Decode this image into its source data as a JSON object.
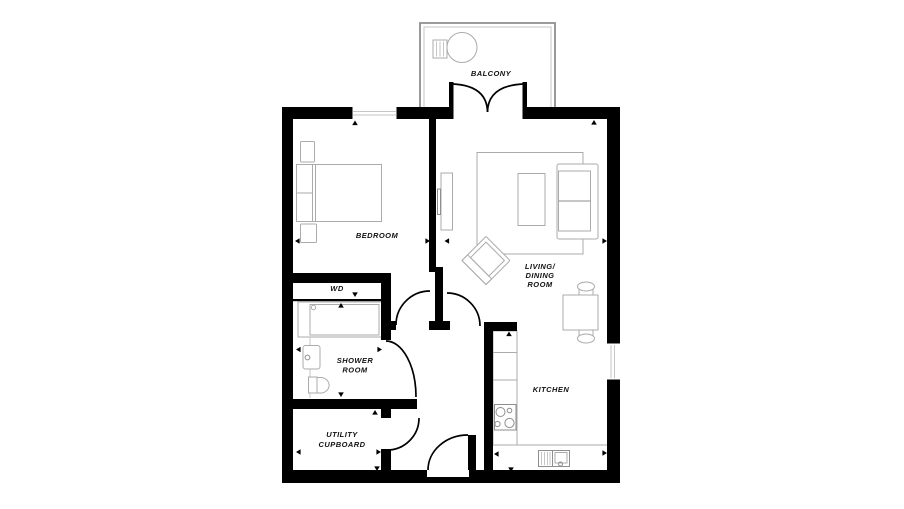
{
  "palette": {
    "wall": "#000000",
    "furniture": "#ababab",
    "detail": "#8f8f8f",
    "glazing": "#c6c6c6",
    "label": "#111111",
    "background": "#ffffff"
  },
  "labels": {
    "balcony": "BALCONY",
    "bedroom": "BEDROOM",
    "living_dining": [
      "LIVING/",
      "DINING",
      "ROOM"
    ],
    "wd": "WD",
    "shower_room": [
      "SHOWER",
      "ROOM"
    ],
    "utility_cupboard": [
      "UTILITY",
      "CUPBOARD"
    ],
    "kitchen": "KITCHEN"
  }
}
